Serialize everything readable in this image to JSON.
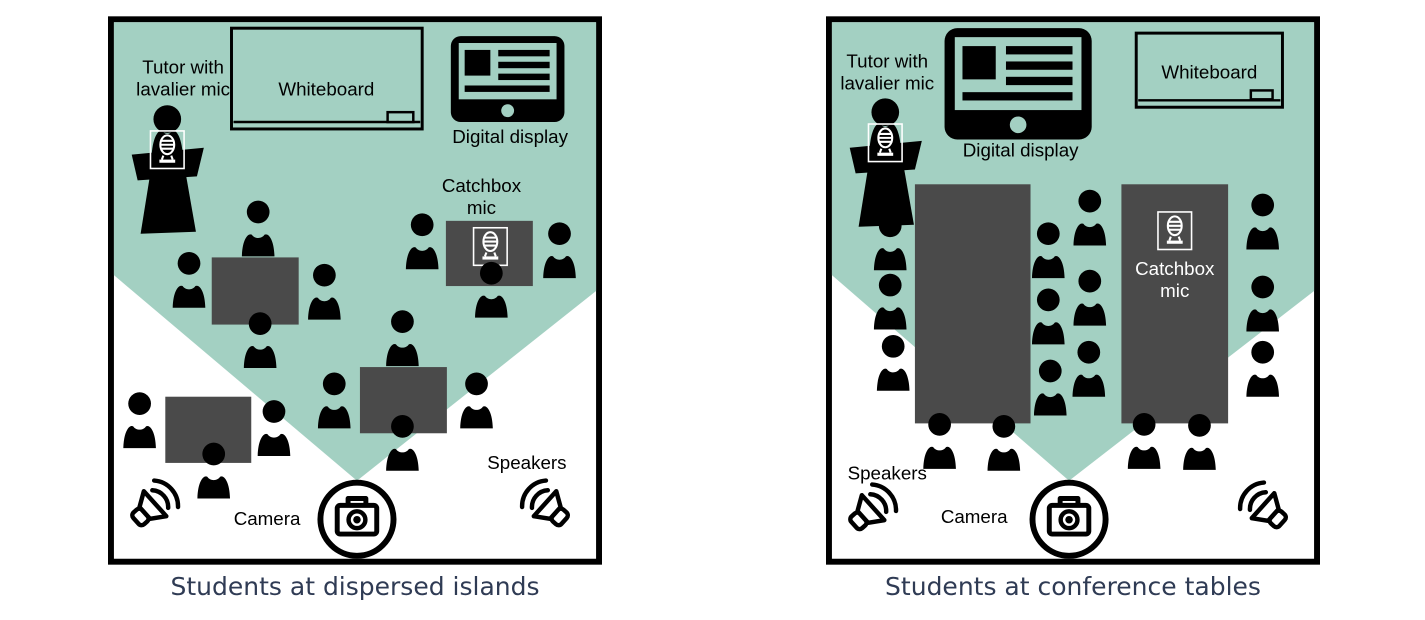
{
  "colors": {
    "zone_teal": "#a3d0c2",
    "table_gray": "#4a4a4a",
    "caption_navy": "#2f3b54",
    "icon_black": "#000000"
  },
  "panels": [
    {
      "caption": "Students at dispersed islands",
      "students_count": 14,
      "tables_count": 4,
      "labels": {
        "tutor_line1": "Tutor with",
        "tutor_line2": "lavalier mic",
        "whiteboard": "Whiteboard",
        "digital_display": "Digital display",
        "catchbox_line1": "Catchbox",
        "catchbox_line2": "mic",
        "speakers": "Speakers",
        "camera": "Camera"
      }
    },
    {
      "caption": "Students at conference tables",
      "students_count": 16,
      "tables_count": 2,
      "labels": {
        "tutor_line1": "Tutor with",
        "tutor_line2": "lavalier mic",
        "whiteboard": "Whiteboard",
        "digital_display": "Digital display",
        "catchbox_line1": "Catchbox",
        "catchbox_line2": "mic",
        "speakers": "Speakers",
        "camera": "Camera"
      }
    }
  ],
  "icons": {
    "student-icon": "person bust silhouette",
    "tutor-at-podium-icon": "person standing behind lectern",
    "lavalier-mic-icon": "retro microphone in white outlined frame",
    "catchbox-mic-icon": "retro microphone in white outlined frame",
    "digital-display-icon": "tablet with picture and text lines on screen",
    "whiteboard-icon": "outlined board with marker tray and eraser",
    "camera-icon": "camera inside a thick circle",
    "speaker-icon": "megaphone with two sound-wave arcs",
    "camera-fov-wedge": "teal wedge showing camera field of view"
  }
}
